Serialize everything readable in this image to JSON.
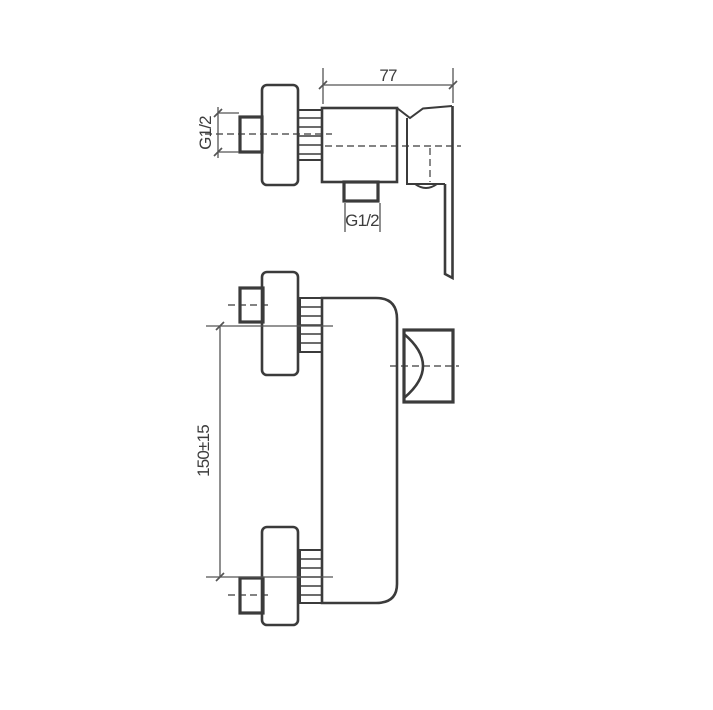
{
  "canvas": {
    "background": "#ffffff",
    "line_color": "#3b3b3b",
    "dim_line_color": "#555555",
    "text_color": "#3d3d3d"
  },
  "drawing": {
    "type": "technical-drawing",
    "subject": "wall-mounted single-lever shower mixer, dimensional drawing, two views"
  },
  "top_view": {
    "dim_width_label": "77",
    "inlet_thread_label": "G1/2",
    "outlet_thread_label": "G1/2"
  },
  "front_view": {
    "dim_height_label": "150±15"
  }
}
